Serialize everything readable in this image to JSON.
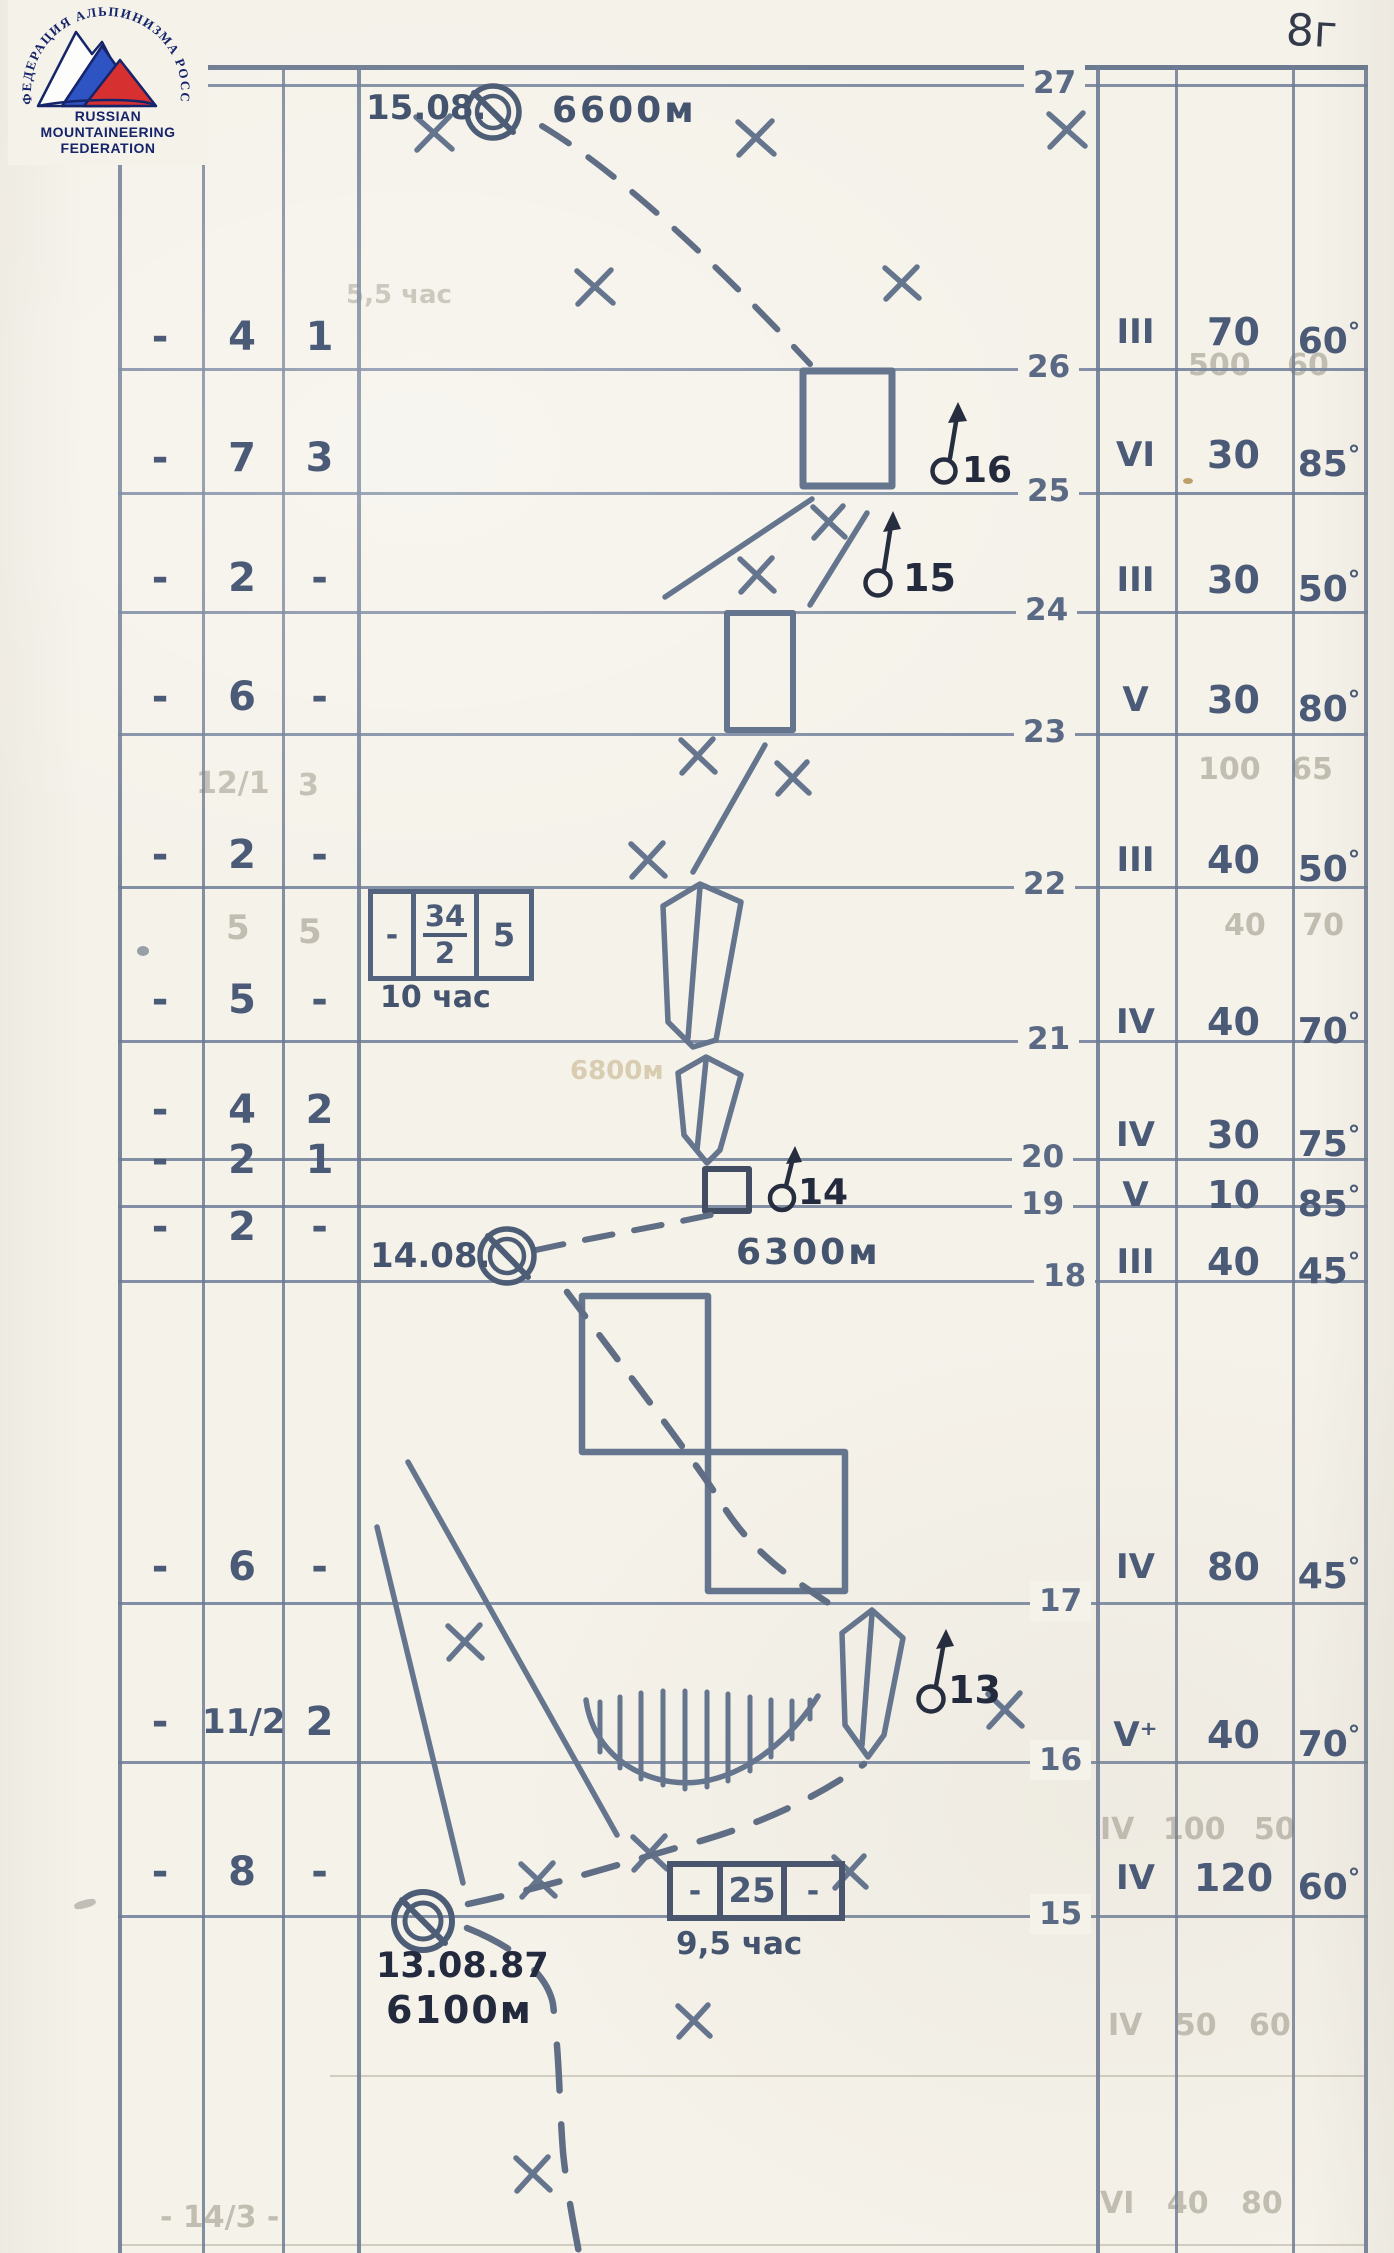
{
  "page": {
    "number": "8г"
  },
  "logo": {
    "arc_text": "ФЕДЕРАЦИЯ АЛЬПИНИЗМА РОССИИ",
    "name_lines": [
      "RUSSIAN",
      "MOUNTAINEERING",
      "FEDERATION"
    ]
  },
  "table": {
    "deg": "°",
    "pitch_lines": [
      "27",
      "26",
      "25",
      "24",
      "23",
      "22",
      "21",
      "20",
      "19",
      "18",
      "17",
      "16",
      "15"
    ],
    "rows": [
      {
        "left": [
          "-",
          "4",
          "1"
        ],
        "grade": "III",
        "length": "70",
        "angle": "60"
      },
      {
        "left": [
          "-",
          "7",
          "3"
        ],
        "grade": "VI",
        "length": "30",
        "angle": "85"
      },
      {
        "left": [
          "-",
          "2",
          "-"
        ],
        "grade": "III",
        "length": "30",
        "angle": "50"
      },
      {
        "left": [
          "-",
          "6",
          "-"
        ],
        "grade": "V",
        "length": "30",
        "angle": "80"
      },
      {
        "left": [
          "-",
          "2",
          "-"
        ],
        "grade": "III",
        "length": "40",
        "angle": "50"
      },
      {
        "left": [
          "-",
          "5",
          "-"
        ],
        "grade": "IV",
        "length": "40",
        "angle": "70"
      },
      {
        "left": [
          "-",
          "4",
          "2"
        ],
        "grade": "IV",
        "length": "30",
        "angle": "75"
      },
      {
        "left": [
          "-",
          "2",
          "1"
        ],
        "grade": "V",
        "length": "10",
        "angle": "85"
      },
      {
        "left": [
          "-",
          "2",
          "-"
        ],
        "grade": "III",
        "length": "40",
        "angle": "45"
      },
      {
        "left": [
          "-",
          "6",
          "-"
        ],
        "grade": "IV",
        "length": "80",
        "angle": "45"
      },
      {
        "left": [
          "-",
          "11/2",
          "2"
        ],
        "grade": "V⁺",
        "length": "40",
        "angle": "70"
      },
      {
        "left": [
          "-",
          "8",
          "-"
        ],
        "grade": "IV",
        "length": "120",
        "angle": "60"
      }
    ]
  },
  "drawing": {
    "camps": [
      {
        "date": "15.08.",
        "elevation": "6600м"
      },
      {
        "date": "14.08.",
        "elevation": "6300м"
      },
      {
        "date": "13.08.87",
        "elevation": "6100м"
      }
    ],
    "stations": [
      "16",
      "15",
      "14",
      "13"
    ],
    "time_box_1": {
      "c1": "-",
      "num": "34",
      "den": "2",
      "c3": "5",
      "time": "10 час"
    },
    "time_box_2": {
      "c1": "-",
      "c2": "25",
      "c3": "-",
      "time": "9,5 час"
    }
  },
  "ghosts": {
    "r1_time": "5,5 час",
    "r1_right": "500 60",
    "r5_left_a": "12/1",
    "r5_left_b": "3",
    "r5_right": "100 65",
    "r6_left_a": "5",
    "r6_left_b": "5",
    "r6_right": "40 70",
    "elev": "6800м",
    "r12_right": "IV 100 50",
    "b1_right": "IV 50 60",
    "b2_right": "VI 40 80",
    "b2_left": "- 14/3 -"
  }
}
